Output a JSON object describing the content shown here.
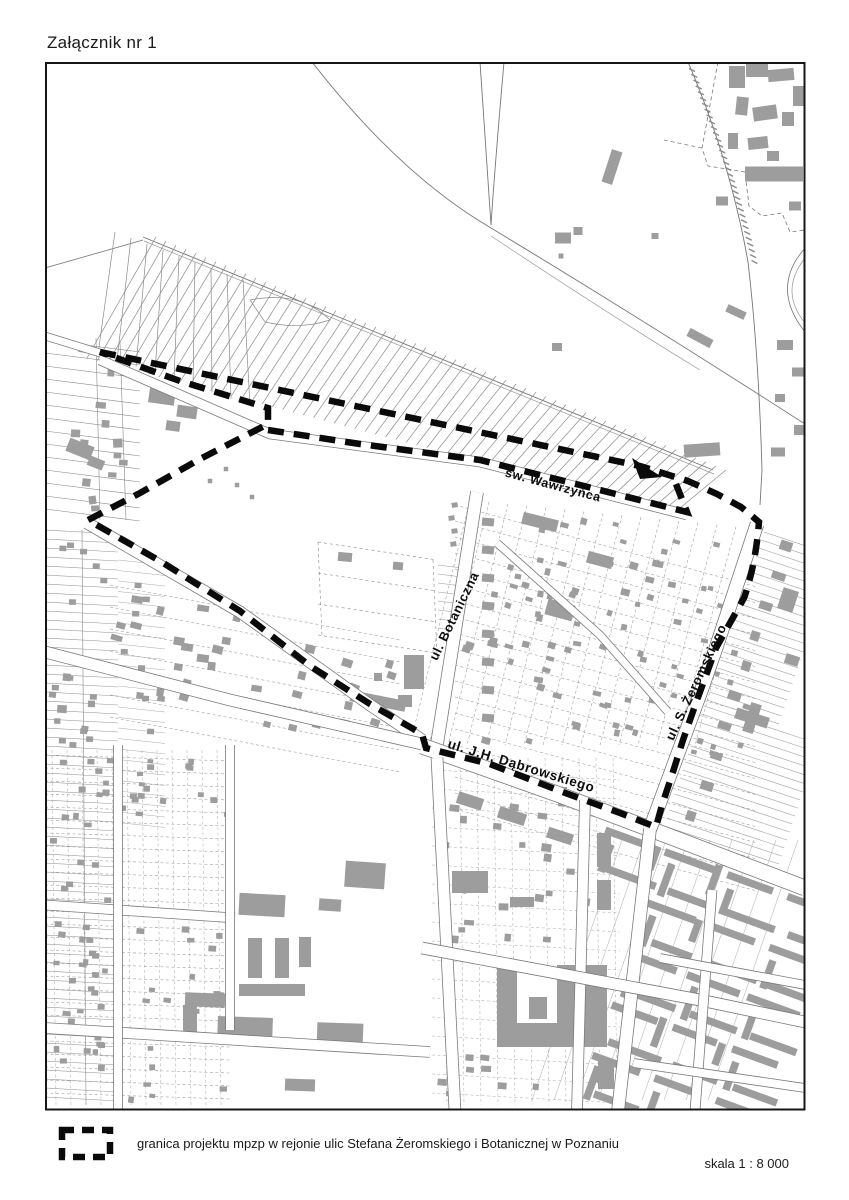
{
  "title": "Załącznik nr 1",
  "map": {
    "street_labels": [
      {
        "id": "wawrzynca",
        "text": "św. Wawrzyńca",
        "x": 552,
        "y": 489,
        "angle": 15,
        "size": 12.5
      },
      {
        "id": "botaniczna",
        "text": "ul. Botaniczna",
        "x": 458,
        "y": 618,
        "angle": -64,
        "size": 13
      },
      {
        "id": "dabrowskiego",
        "text": "ul. J.H. Dąbrowskiego",
        "x": 520,
        "y": 770,
        "angle": 17,
        "size": 13.5
      },
      {
        "id": "zeromskiego",
        "text": "ul. S. Żeromskiego",
        "x": 700,
        "y": 684,
        "angle": -65,
        "size": 13
      }
    ]
  },
  "legend": {
    "symbol": "project-boundary-dashed-rectangle",
    "label": "granica projektu mpzp w rejonie ulic Stefana Żeromskiego i Botanicznej w Poznaniu"
  },
  "scale": {
    "label": "skala 1 : 8 000"
  },
  "colors": {
    "building": "#9d9d9d",
    "parcel_line": "#7a7a7a",
    "boundary": "#0a0a0a",
    "frame": "#161616"
  }
}
